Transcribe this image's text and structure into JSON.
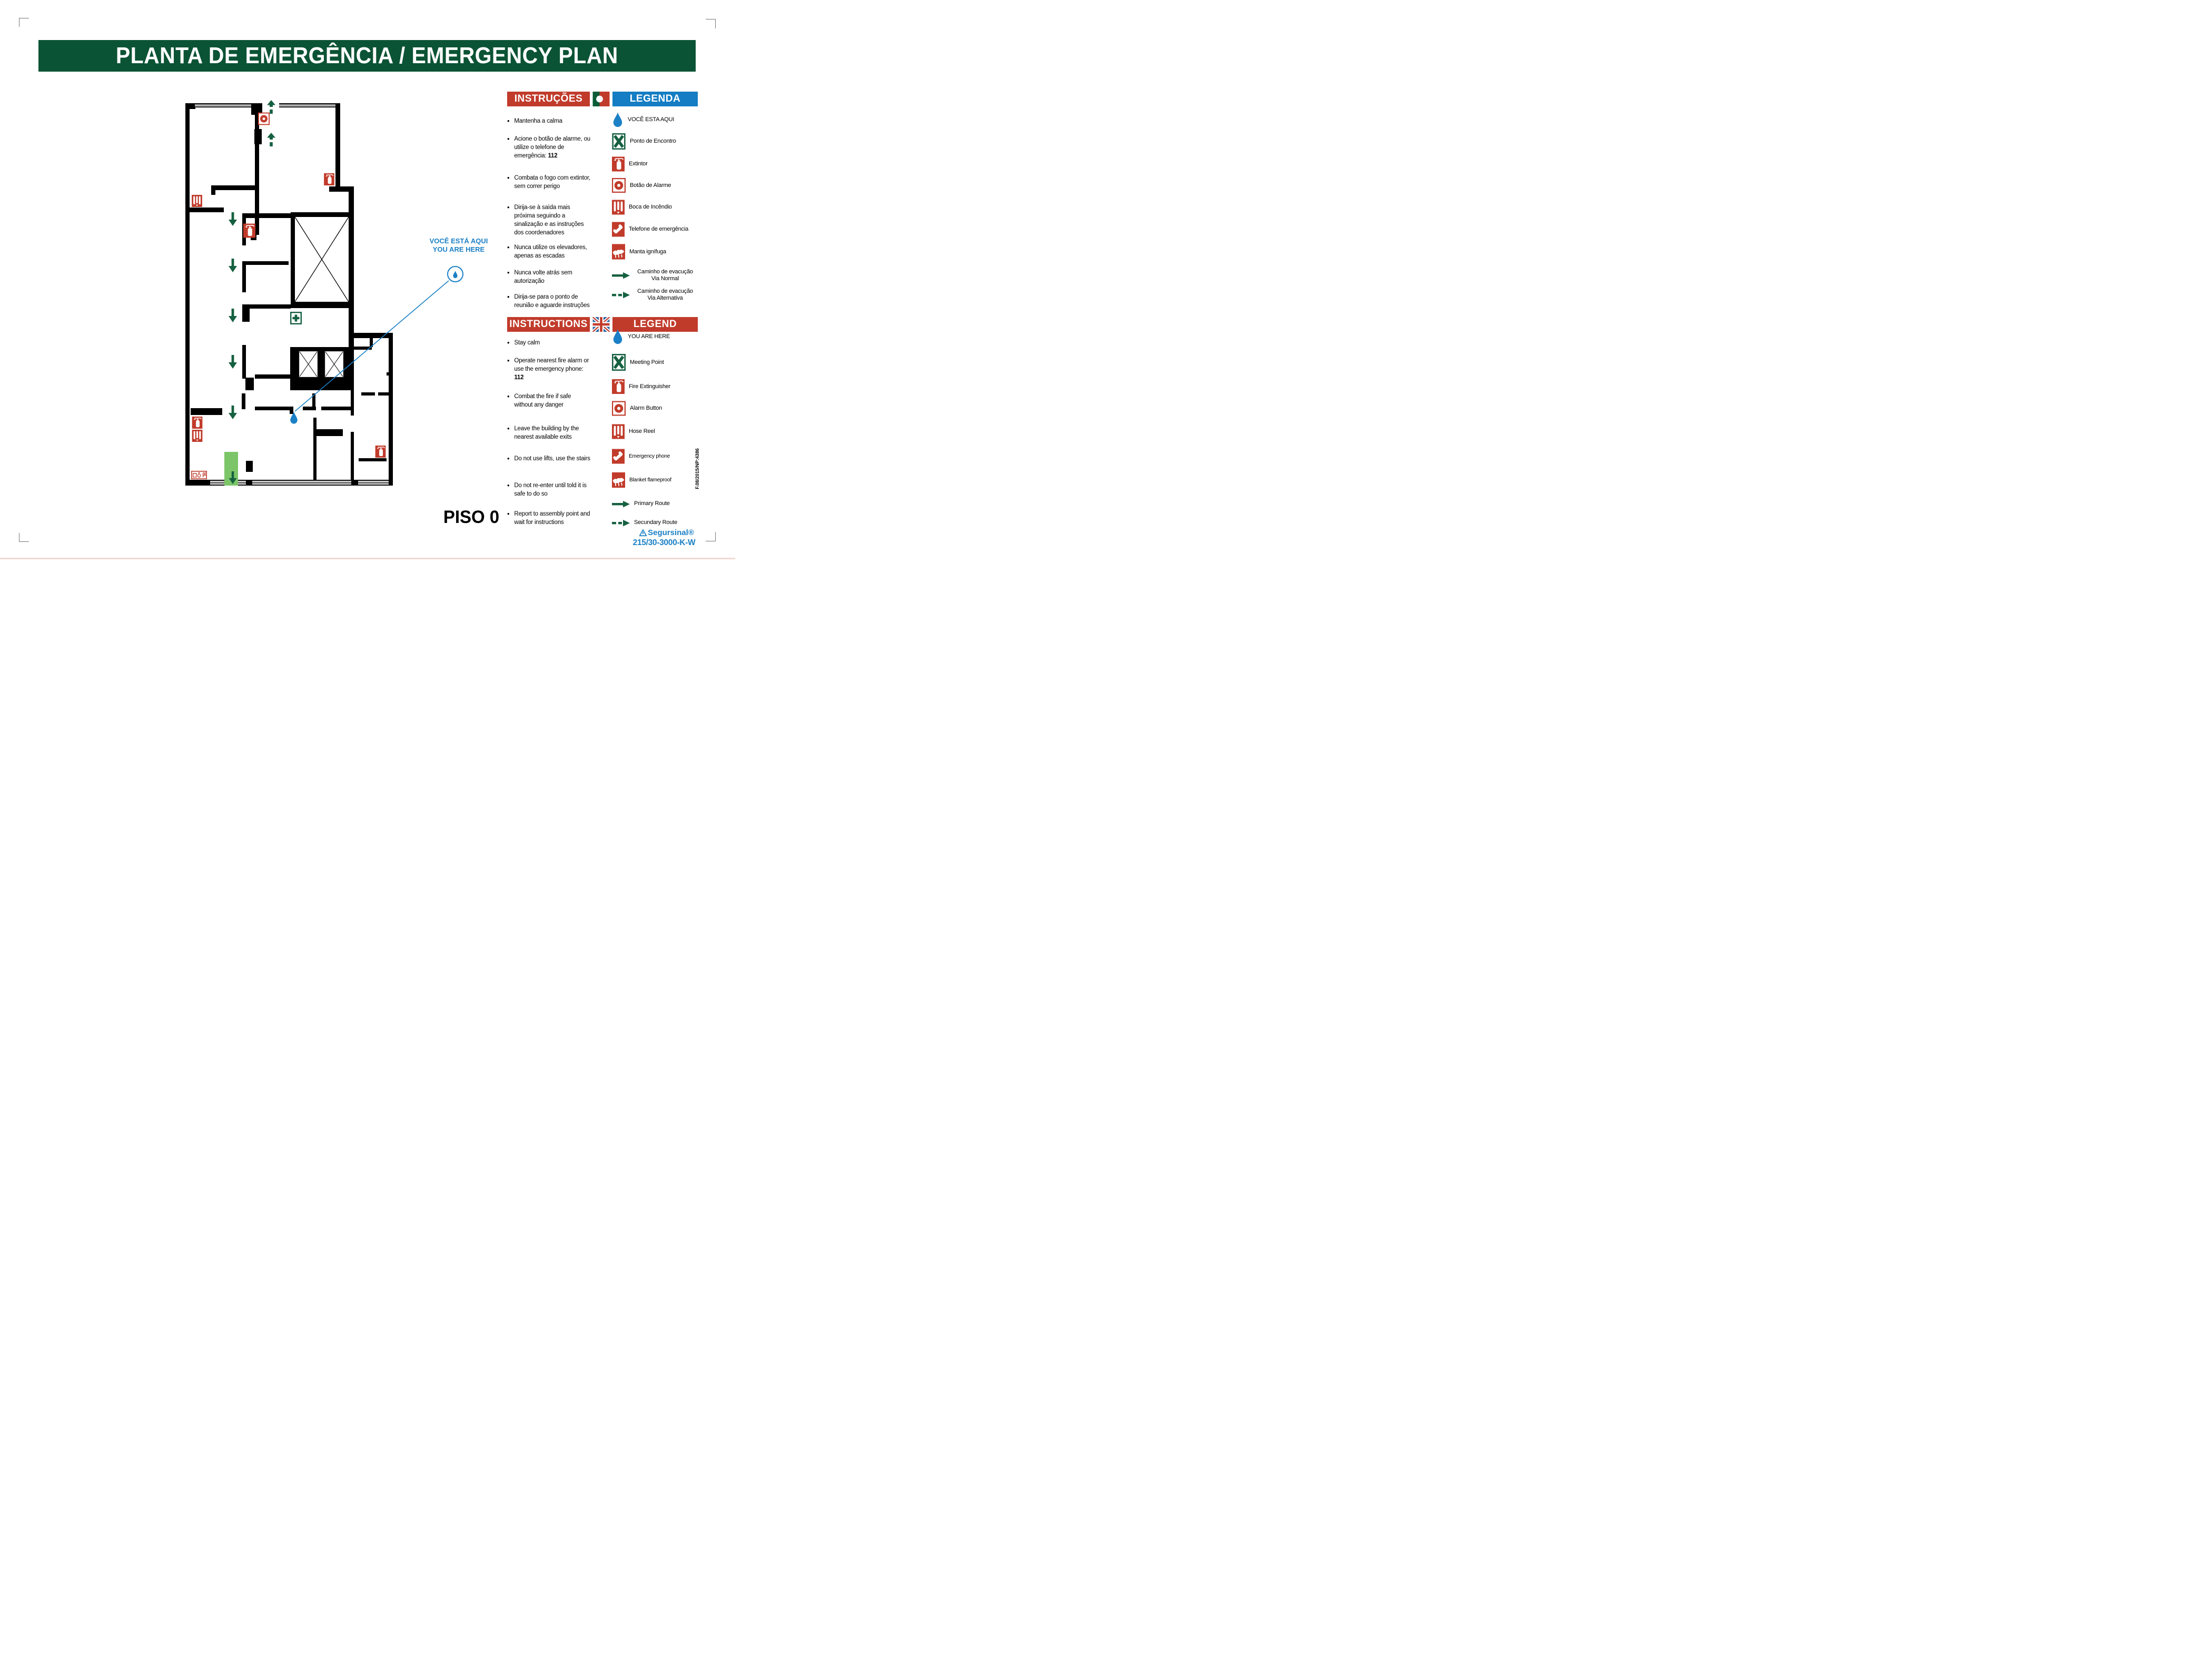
{
  "title_banner": "PLANTA DE EMERGÊNCIA / EMERGENCY PLAN",
  "floor_label": "PISO 0",
  "plan": {
    "you_are_here_pt": "VOCÊ ESTÁ AQUI",
    "you_are_here_en": "YOU ARE HERE",
    "marker_icons": [
      "you-are-here-droplet",
      "alarm-button",
      "fire-extinguisher",
      "hose-reel",
      "first-aid",
      "signs-panel",
      "exit-route"
    ]
  },
  "pt": {
    "instructions_header": "INSTRUÇÕES",
    "legend_header": "LEGENDA",
    "flag_icon": "portugal-flag-icon",
    "instructions": [
      {
        "text": "Mantenha a calma"
      },
      {
        "text": "Acione o botão de alarme, ou utilize o telefone de emergência: ",
        "bold": "112"
      },
      {
        "text": "Combata o fogo com extintor, sem correr perigo"
      },
      {
        "text": "Dirija-se à saìda mais próxima seguindo a sinalização e as instruções dos coordenadores"
      },
      {
        "text": "Nunca utilize os elevadores, apenas as escadas"
      },
      {
        "text": "Nunca volte atrás sem autorização"
      },
      {
        "text": "Dirija-se para o ponto de reunião e aguarde instruções"
      }
    ],
    "legend": [
      {
        "icon": "droplet-icon",
        "label": "VOCÊ ESTA AQUI"
      },
      {
        "icon": "meeting-point-icon",
        "label": "Ponto de Encontro"
      },
      {
        "icon": "extinguisher-icon",
        "label": "Extintor"
      },
      {
        "icon": "alarm-button-icon",
        "label": "Botão de Alarme"
      },
      {
        "icon": "hose-reel-icon",
        "label": "Boca de Incêndio"
      },
      {
        "icon": "emergency-phone-icon",
        "label": "Telefone de emergência"
      },
      {
        "icon": "fire-blanket-icon",
        "label": "Manta ignífuga"
      },
      {
        "icon": "solid-arrow-icon",
        "label": "Caminho de evacução",
        "label2": "Via Normal"
      },
      {
        "icon": "dashed-arrow-icon",
        "label": "Caminho de evacução",
        "label2": "Via Alternativa"
      }
    ]
  },
  "en": {
    "instructions_header": "INSTRUCTIONS",
    "legend_header": "LEGEND",
    "flag_icon": "uk-flag-icon",
    "instructions": [
      {
        "text": "Stay calm"
      },
      {
        "text": "Operate nearest fire alarm or use the emergency phone: ",
        "bold": "112"
      },
      {
        "text": "Combat the fire if safe without any danger"
      },
      {
        "text": "Leave the building by the nearest available exits"
      },
      {
        "text": "Do not use lifts, use the stairs"
      },
      {
        "text": "Do not re-enter until told it is safe to do so"
      },
      {
        "text": "Report to assembly point and wait for instructions"
      }
    ],
    "legend": [
      {
        "icon": "droplet-icon",
        "label": "YOU ARE HERE"
      },
      {
        "icon": "meeting-point-icon",
        "label": "Meeting Point"
      },
      {
        "icon": "extinguisher-icon",
        "label": "Fire Extinguisher"
      },
      {
        "icon": "alarm-button-icon",
        "label": "Alarm Button"
      },
      {
        "icon": "hose-reel-icon",
        "label": "Hose Reel"
      },
      {
        "icon": "emergency-phone-icon",
        "label": "Emergency phone"
      },
      {
        "icon": "fire-blanket-icon",
        "label": "Blanket flameproof"
      },
      {
        "icon": "solid-arrow-icon",
        "label": "Primary Route"
      },
      {
        "icon": "dashed-arrow-icon",
        "label": "Secundary Route"
      }
    ]
  },
  "footer": {
    "brand": "Segursinal®",
    "product_code": "215/30-3000-K-W",
    "doc_code": "F.08/2015/NP:4386"
  },
  "colors": {
    "banner_green": "#0b5335",
    "header_red": "#c13b2b",
    "header_blue": "#147dc3",
    "route_green": "#156040",
    "exit_green": "#7cc568",
    "marker_blue": "#1b80c6",
    "flag_green": "#0a5c36"
  }
}
